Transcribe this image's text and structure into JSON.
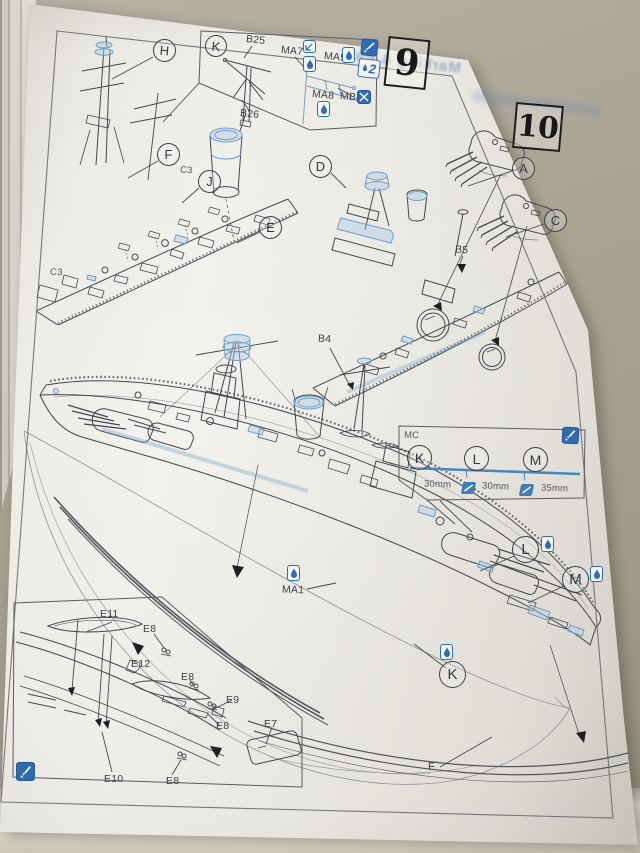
{
  "colors": {
    "accent_blue": "#3f7cb8",
    "cable_line": "#4a86c0",
    "highlight_blue": "#7ba3c8",
    "page": "#e9e7e2",
    "background": "#a9a396",
    "line_art": "#45474f"
  },
  "icons": {
    "glue": "glue-icon",
    "bend": "bend-icon",
    "cut": "cut-icon",
    "paintbrush": "paintbrush-icon",
    "cable_cut": "cut-cable-icon"
  },
  "page": {
    "steps": {
      "nine": "9",
      "ten": "10"
    },
    "inset_k": {
      "callout": "K",
      "b25": "B25",
      "b26": "B26",
      "ma7": "MA7",
      "ma9": "MA9",
      "ma8": "MA8",
      "mb6": "MB6",
      "qty": "2"
    },
    "view9": {
      "h": "H",
      "f": "F",
      "j": "J",
      "e": "E",
      "c3a": "C3",
      "c3b": "C3"
    },
    "view10": {
      "d": "D",
      "a": "A",
      "c": "C",
      "b5": "B5",
      "b4": "B4"
    },
    "cable_guide": {
      "code": "MC",
      "k": "K",
      "l": "L",
      "m": "M",
      "len_k": "30mm",
      "len_l": "30mm",
      "len_m": "35mm"
    },
    "main_view": {
      "ma1": "MA1",
      "l": "L",
      "m": "M",
      "k": "K",
      "f": "F"
    },
    "inset_e": {
      "e11": "E11",
      "e8a": "E8",
      "e12": "E12",
      "e8b": "E8",
      "e9": "E9",
      "e8c": "E8",
      "e7": "E7",
      "e10": "E10",
      "e8d": "E8"
    },
    "bleed_text": "Marking & Pa"
  }
}
